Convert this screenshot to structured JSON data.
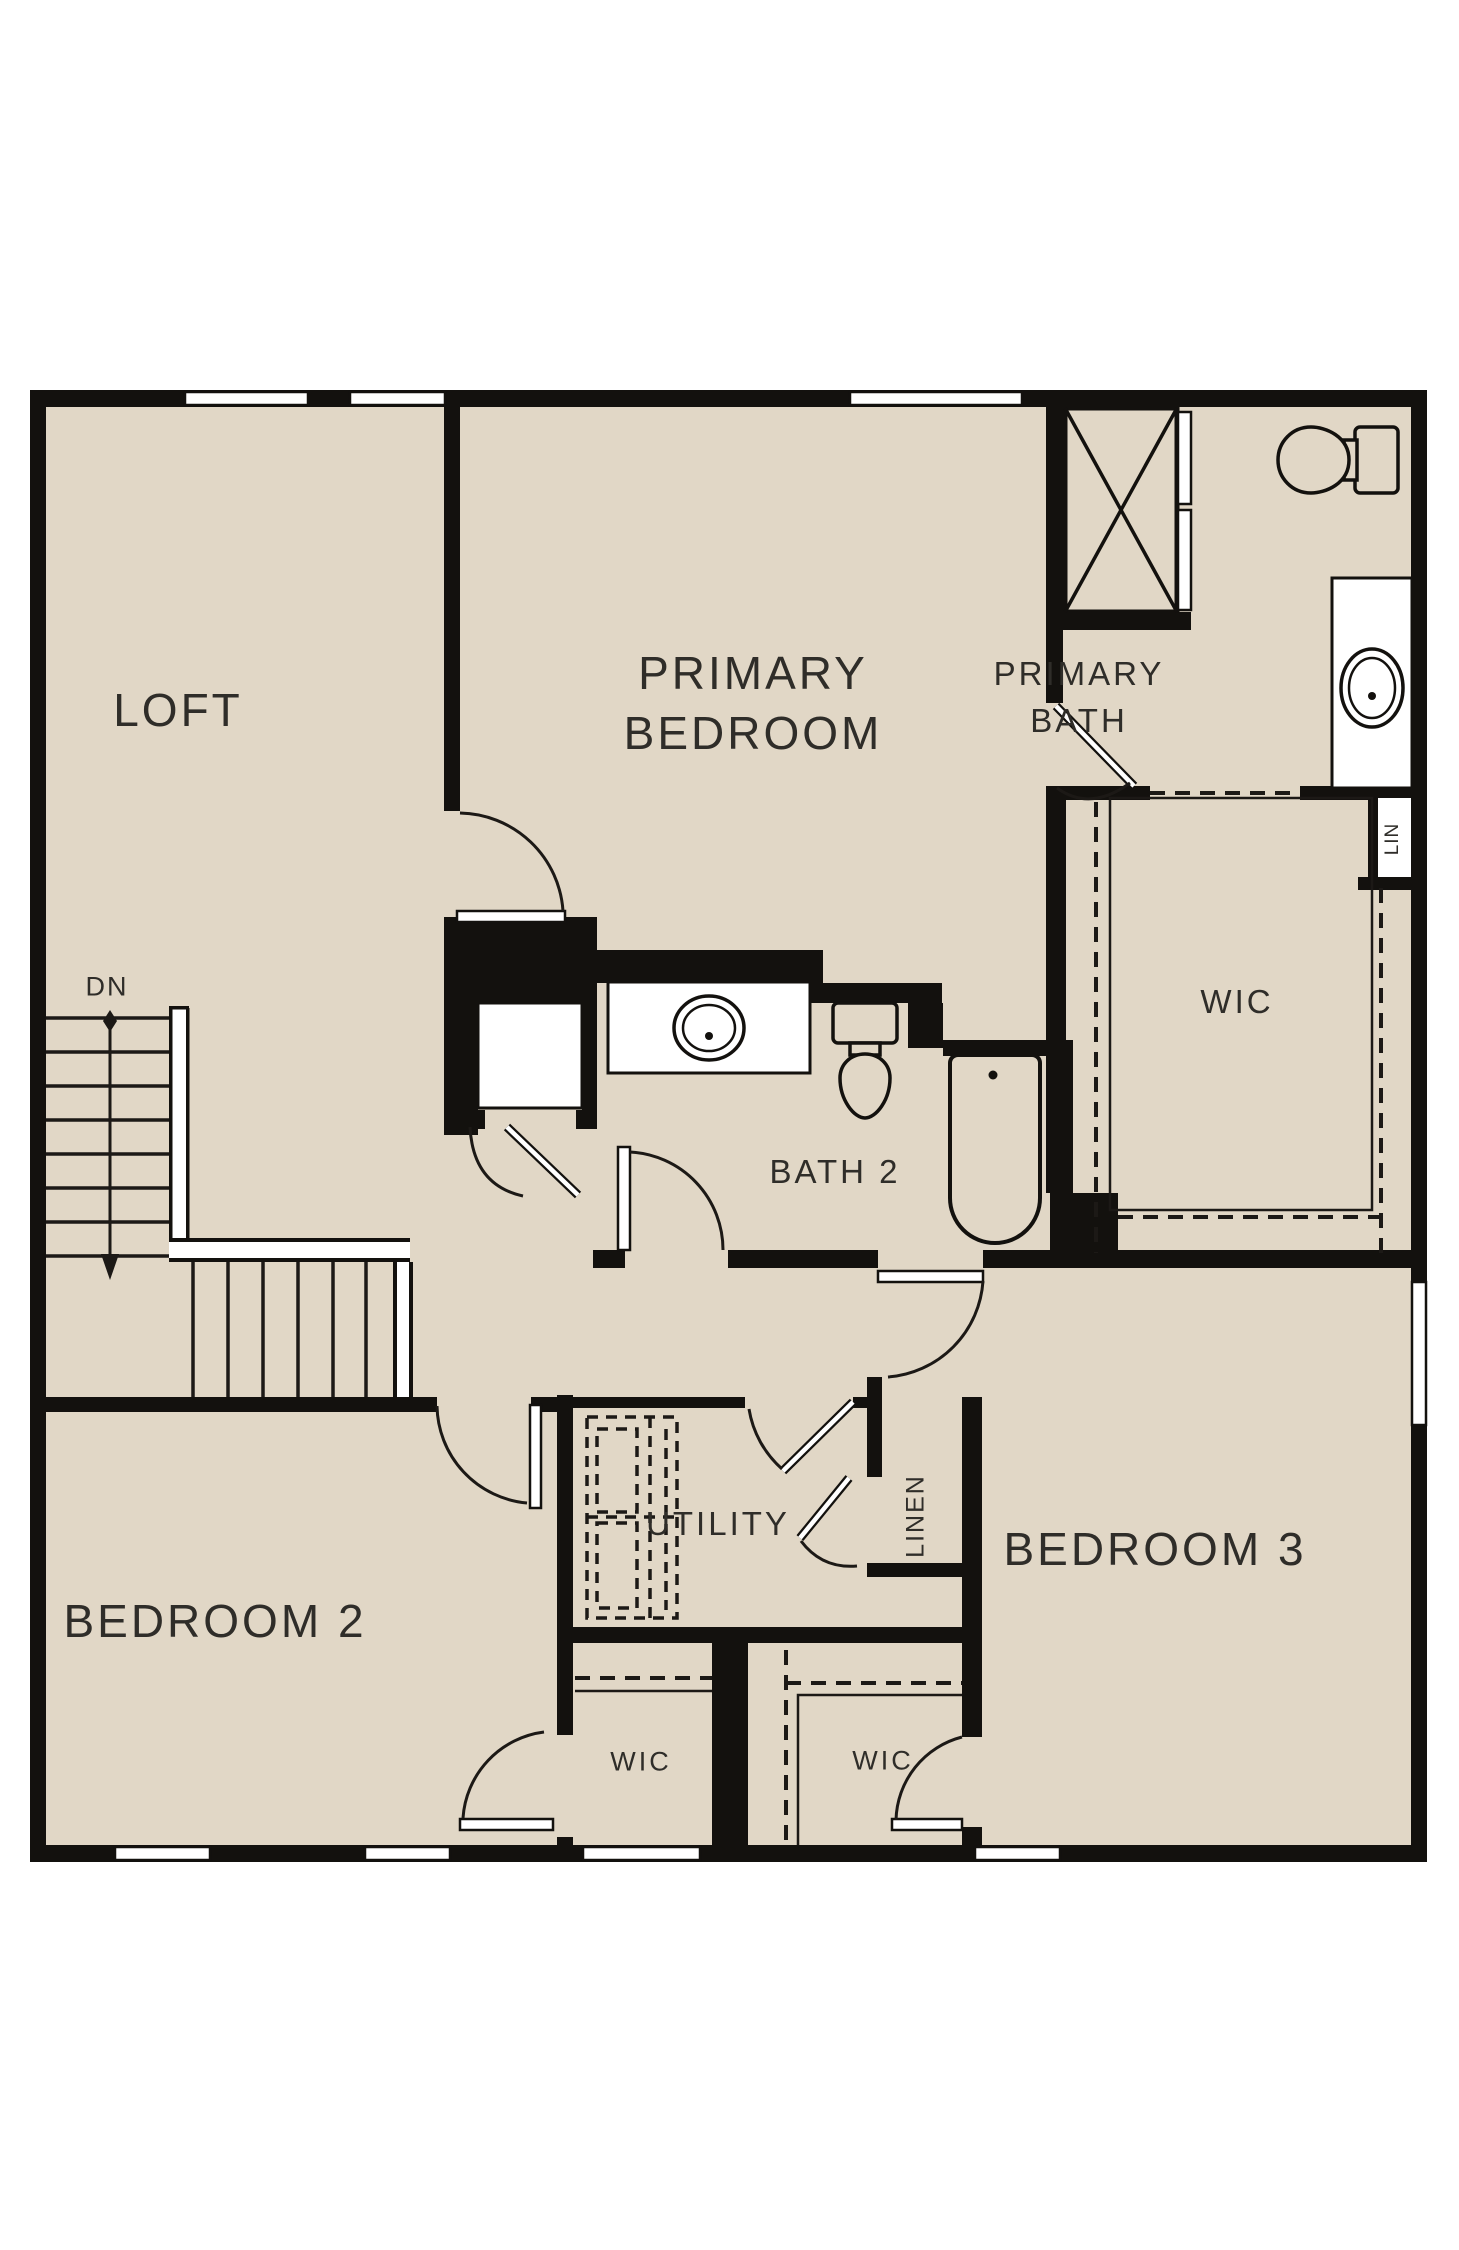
{
  "page": {
    "type": "floor-plan",
    "background": "#ffffff"
  },
  "palette": {
    "floor": "#e1d7c6",
    "wall": "#13110e",
    "line": "#1c1916",
    "text": "#2f2d29",
    "white": "#ffffff"
  },
  "labels": {
    "loft": "LOFT",
    "primary_bedroom_line1": "PRIMARY",
    "primary_bedroom_line2": "BEDROOM",
    "primary_bath_line1": "PRIMARY",
    "primary_bath_line2": "BATH",
    "wic_primary": "WIC",
    "bath2": "BATH 2",
    "down": "DN",
    "utility": "UTILITY",
    "linen": "LINEN",
    "lin": "LIN",
    "bedroom2": "BEDROOM 2",
    "bedroom3": "BEDROOM 3",
    "wic_bedroom2": "WIC",
    "wic_bedroom3": "WIC"
  },
  "fixtures": [
    "shower-icon",
    "toilet-icon",
    "sink-icon",
    "bathtub-icon",
    "washer-dryer-icon",
    "stairs-icon",
    "door-swing-icon",
    "window-icon"
  ]
}
